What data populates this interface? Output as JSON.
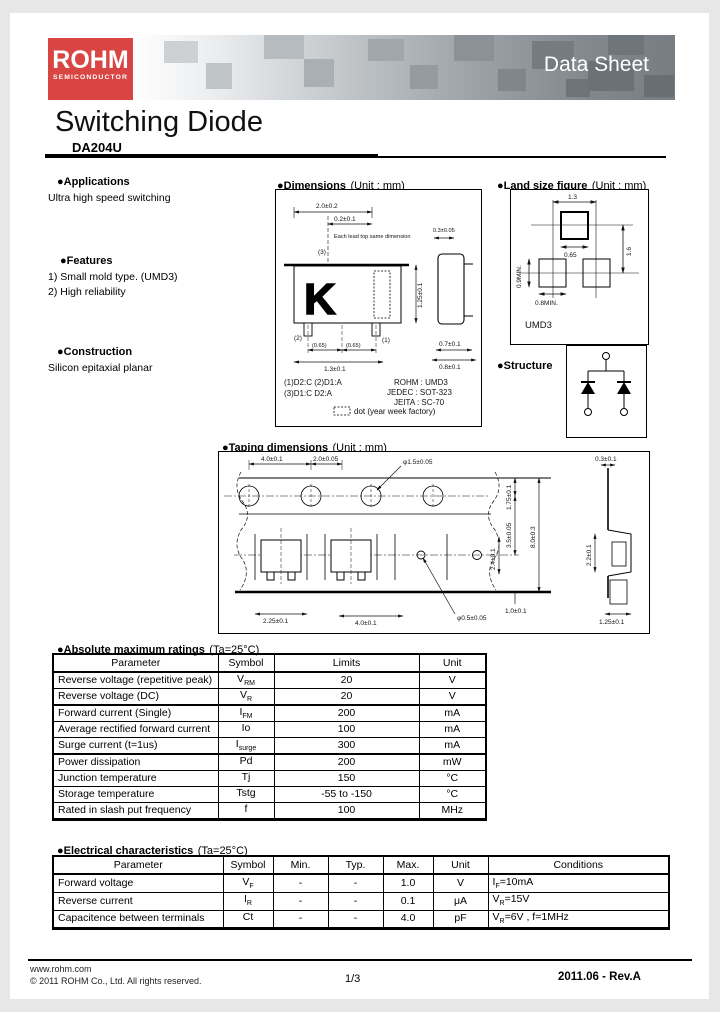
{
  "colors": {
    "logo_red": "#d94543",
    "banner_dark": "#6a7177",
    "banner_mid": "#8b9196"
  },
  "header": {
    "logo_line1": "ROHM",
    "logo_line2": "SEMICONDUCTOR",
    "banner_title": "Data Sheet"
  },
  "title": {
    "main": "Switching Diode",
    "part": "DA204U"
  },
  "sections": {
    "applications": {
      "heading": "●Applications",
      "body": "Ultra high speed switching"
    },
    "features": {
      "heading": "●Features",
      "items": [
        "1) Small mold type. (UMD3)",
        "2) High reliability"
      ]
    },
    "construction": {
      "heading": "●Construction",
      "body": "Silicon epitaxial planar"
    }
  },
  "dims": {
    "heading_bold": "●Dimensions",
    "heading_normal": "(Unit : mm)",
    "top_width": "2.0±0.2",
    "top_offset": "0.2±0.1",
    "note": "Each lead top same dimension",
    "note_dim": "0.3±0.05",
    "pin1": "(1)",
    "pin2": "(2)",
    "pin3": "(3)",
    "bot1": "(0.65)",
    "bot2": "(0.65)",
    "bot_width": "1.3±0.1",
    "right_height": "1.25±0.1",
    "marking": "K",
    "side_w1": "0.7±0.1",
    "side_w2": "0.8±0.1",
    "pins_line1": "(1)D2:C  (2)D1:A",
    "pins_line2": "(3)D1:C  D2:A",
    "std1": "ROHM : UMD3",
    "std2": "JEDEC : SOT-323",
    "std3": "JEITA : SC-70",
    "dot_note": "dot (year week factory)"
  },
  "land": {
    "heading_bold": "●Land size figure",
    "heading_normal": "(Unit : mm)",
    "d_w": "1.3",
    "d_pad": "0.65",
    "d_h": "1.6",
    "d_left": "0.9MIN.",
    "d_bot": "0.8MIN.",
    "label": "UMD3"
  },
  "structure": {
    "heading": "●Structure"
  },
  "taping": {
    "heading_bold": "●Taping dimensions",
    "heading_normal": "(Unit : mm)",
    "t1": "4.0±0.1",
    "t2": "2.0±0.05",
    "t3": "φ1.5±0.05",
    "r1": "1.75±0.1",
    "r2": "3.5±0.05",
    "r3": "8.0±0.3",
    "r4": "1.0±0.1",
    "rv": "2.4±0.1",
    "b1": "2.25±0.1",
    "b2": "4.0±0.1",
    "hole": "φ0.5±0.05",
    "s1": "0.3±0.1",
    "s2": "2.2±0.1",
    "s3": "1.25±0.1"
  },
  "amr": {
    "heading_bold": "●Absolute maximum ratings",
    "heading_normal": "(Ta=25°C)",
    "headers": [
      "Parameter",
      "Symbol",
      "Limits",
      "Unit"
    ],
    "rows": [
      {
        "param": "Reverse voltage (repetitive peak)",
        "sym": "V",
        "sub": "RM",
        "limit": "20",
        "unit": "V"
      },
      {
        "param": "Reverse voltage (DC)",
        "sym": "V",
        "sub": "R",
        "limit": "20",
        "unit": "V"
      },
      {
        "param": "Forward current (Single)",
        "sym": "I",
        "sub": "FM",
        "limit": "200",
        "unit": "mA"
      },
      {
        "param": "Average rectified forward current",
        "sym": "Io",
        "sub": "",
        "limit": "100",
        "unit": "mA"
      },
      {
        "param": "Surge current (t=1us)",
        "sym": "I",
        "sub": "surge",
        "limit": "300",
        "unit": "mA"
      },
      {
        "param": "Power dissipation",
        "sym": "Pd",
        "sub": "",
        "limit": "200",
        "unit": "mW"
      },
      {
        "param": "Junction temperature",
        "sym": "Tj",
        "sub": "",
        "limit": "150",
        "unit": "°C"
      },
      {
        "param": "Storage temperature",
        "sym": "Tstg",
        "sub": "",
        "limit": "-55 to -150",
        "unit": "°C"
      },
      {
        "param": "Rated in slash put frequency",
        "sym": "f",
        "sub": "",
        "limit": "100",
        "unit": "MHz"
      }
    ]
  },
  "ec": {
    "heading_bold": "●Electrical characteristics",
    "heading_normal": "(Ta=25°C)",
    "headers": [
      "Parameter",
      "Symbol",
      "Min.",
      "Typ.",
      "Max.",
      "Unit",
      "Conditions"
    ],
    "rows": [
      {
        "param": "Forward voltage",
        "sym": "V",
        "sub": "F",
        "min": "-",
        "typ": "-",
        "max": "1.0",
        "unit": "V",
        "cpre": "I",
        "csub": "F",
        "cpost": "=10mA"
      },
      {
        "param": "Reverse current",
        "sym": "I",
        "sub": "R",
        "min": "-",
        "typ": "-",
        "max": "0.1",
        "unit": "μA",
        "cpre": "V",
        "csub": "R",
        "cpost": "=15V"
      },
      {
        "param": "Capacitence between terminals",
        "sym": "Ct",
        "sub": "",
        "min": "-",
        "typ": "-",
        "max": "4.0",
        "unit": "pF",
        "cpre": "V",
        "csub": "R",
        "cpost": "=6V , f=1MHz"
      }
    ]
  },
  "footer": {
    "url": "www.rohm.com",
    "copyright": "© 2011  ROHM Co., Ltd. All rights reserved.",
    "page": "1/3",
    "rev": "2011.06 -  Rev.A"
  }
}
